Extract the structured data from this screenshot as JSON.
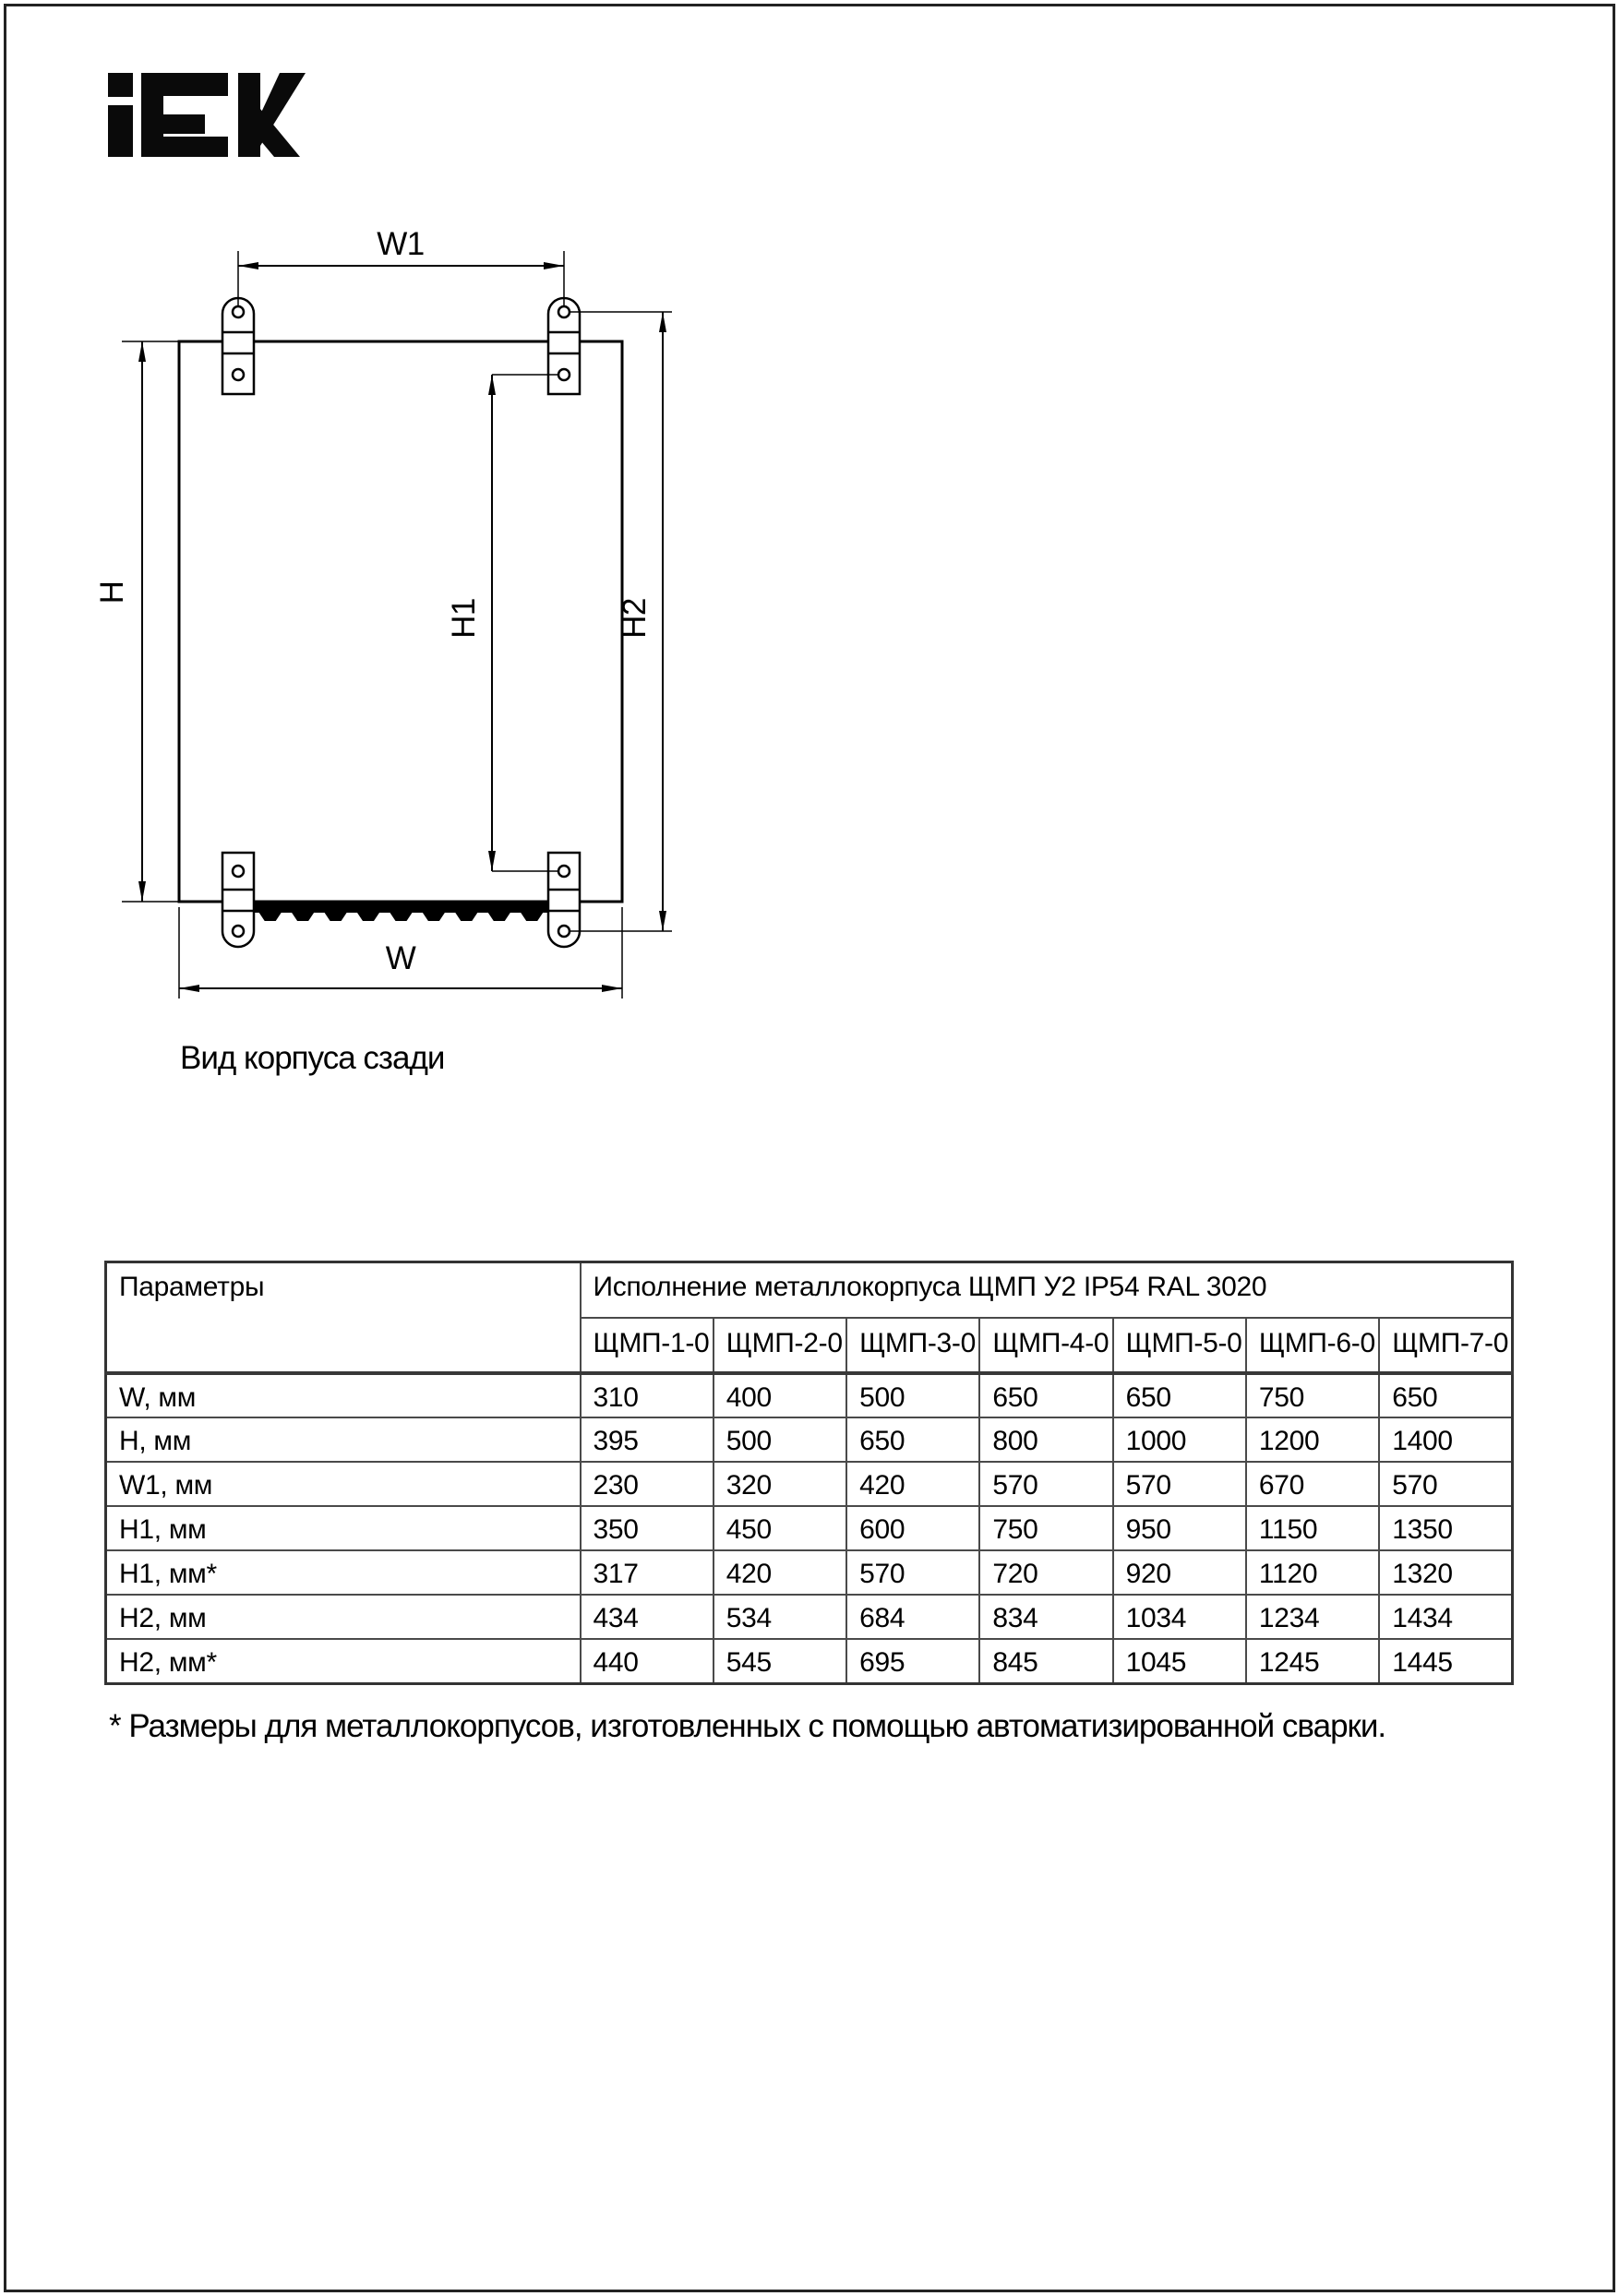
{
  "logo": {
    "brand": "IEK"
  },
  "diagram": {
    "labels": {
      "w1": "W1",
      "h": "H",
      "h1": "H1",
      "h2": "H2",
      "w": "W"
    },
    "caption": "Вид корпуса сзади"
  },
  "table": {
    "param_header": "Параметры",
    "group_header": "Исполнение металлокорпуса ЩМП У2 IP54 RAL 3020",
    "columns": [
      "ЩМП-1-0",
      "ЩМП-2-0",
      "ЩМП-3-0",
      "ЩМП-4-0",
      "ЩМП-5-0",
      "ЩМП-6-0",
      "ЩМП-7-0"
    ],
    "rows": [
      {
        "label": "W, мм",
        "values": [
          "310",
          "400",
          "500",
          "650",
          "650",
          "750",
          "650"
        ]
      },
      {
        "label": "H, мм",
        "values": [
          "395",
          "500",
          "650",
          "800",
          "1000",
          "1200",
          "1400"
        ]
      },
      {
        "label": "W1, мм",
        "values": [
          "230",
          "320",
          "420",
          "570",
          "570",
          "670",
          "570"
        ]
      },
      {
        "label": "H1, мм",
        "values": [
          "350",
          "450",
          "600",
          "750",
          "950",
          "1150",
          "1350"
        ]
      },
      {
        "label": "H1, мм*",
        "values": [
          "317",
          "420",
          "570",
          "720",
          "920",
          "1120",
          "1320"
        ]
      },
      {
        "label": "H2, мм",
        "values": [
          "434",
          "534",
          "684",
          "834",
          "1034",
          "1234",
          "1434"
        ]
      },
      {
        "label": "H2, мм*",
        "values": [
          "440",
          "545",
          "695",
          "845",
          "1045",
          "1245",
          "1445"
        ]
      }
    ]
  },
  "footnote": "* Размеры для металлокорпусов, изготовленных с помощью автоматизированной сварки."
}
